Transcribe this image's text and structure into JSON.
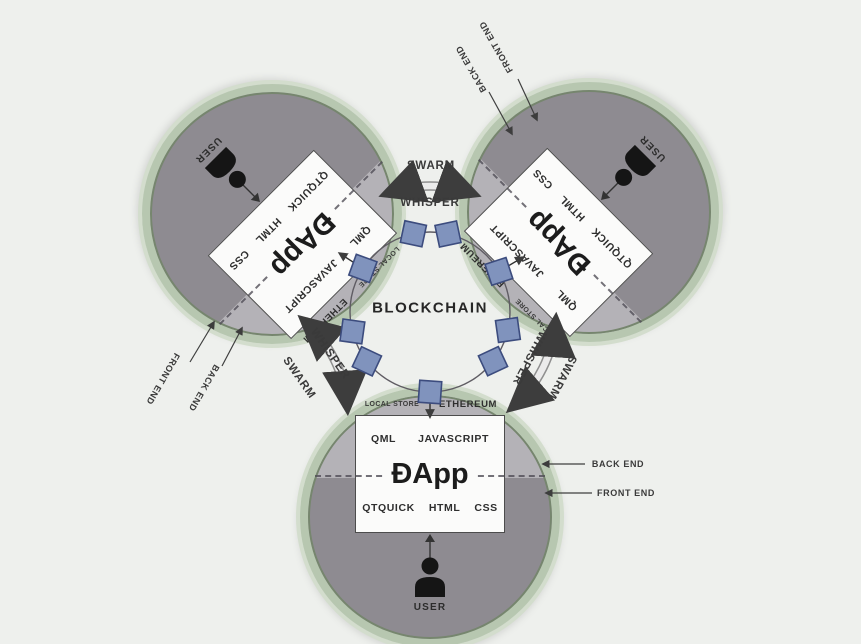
{
  "diagram": {
    "center_label": "BLOCKCHAIN",
    "bands": {
      "swarm": "SWARM",
      "whisper": "WHISPER"
    },
    "annotations": {
      "back_end": "BACK END",
      "front_end": "FRONT END"
    },
    "pods": [
      {
        "name": "dapp-top-left",
        "dapp": "ĐApp",
        "stack_top": [
          "QML",
          "JAVASCRIPT"
        ],
        "stack_bottom": [
          "QTQUICK",
          "HTML",
          "CSS"
        ],
        "user": "USER",
        "local_store": "LOCAL STORE",
        "ethereum": "ETHEREUM",
        "user_icon": "person-silhouette"
      },
      {
        "name": "dapp-top-right",
        "dapp": "ĐApp",
        "stack_top": [
          "QML",
          "JAVASCRIPT"
        ],
        "stack_bottom": [
          "QTQUICK",
          "HTML",
          "CSS"
        ],
        "user": "USER",
        "local_store": "LOCAL STORE",
        "ethereum": "ETHEREUM",
        "user_icon": "person-silhouette"
      },
      {
        "name": "dapp-bottom",
        "dapp": "ĐApp",
        "stack_top": [
          "QML",
          "JAVASCRIPT"
        ],
        "stack_bottom": [
          "QTQUICK",
          "HTML",
          "CSS"
        ],
        "user": "USER",
        "local_store": "LOCAL STORE",
        "ethereum": "ETHEREUM",
        "user_icon": "person-silhouette"
      }
    ],
    "colors": {
      "background": "#eef0ed",
      "ring_green": "#b7c7b0",
      "back_end_region": "#b4b2b7",
      "front_end_region": "#8e8b91",
      "node_fill": "#8093bd",
      "node_border": "#3c4c7e",
      "box_fill": "#fbfbfa"
    }
  }
}
